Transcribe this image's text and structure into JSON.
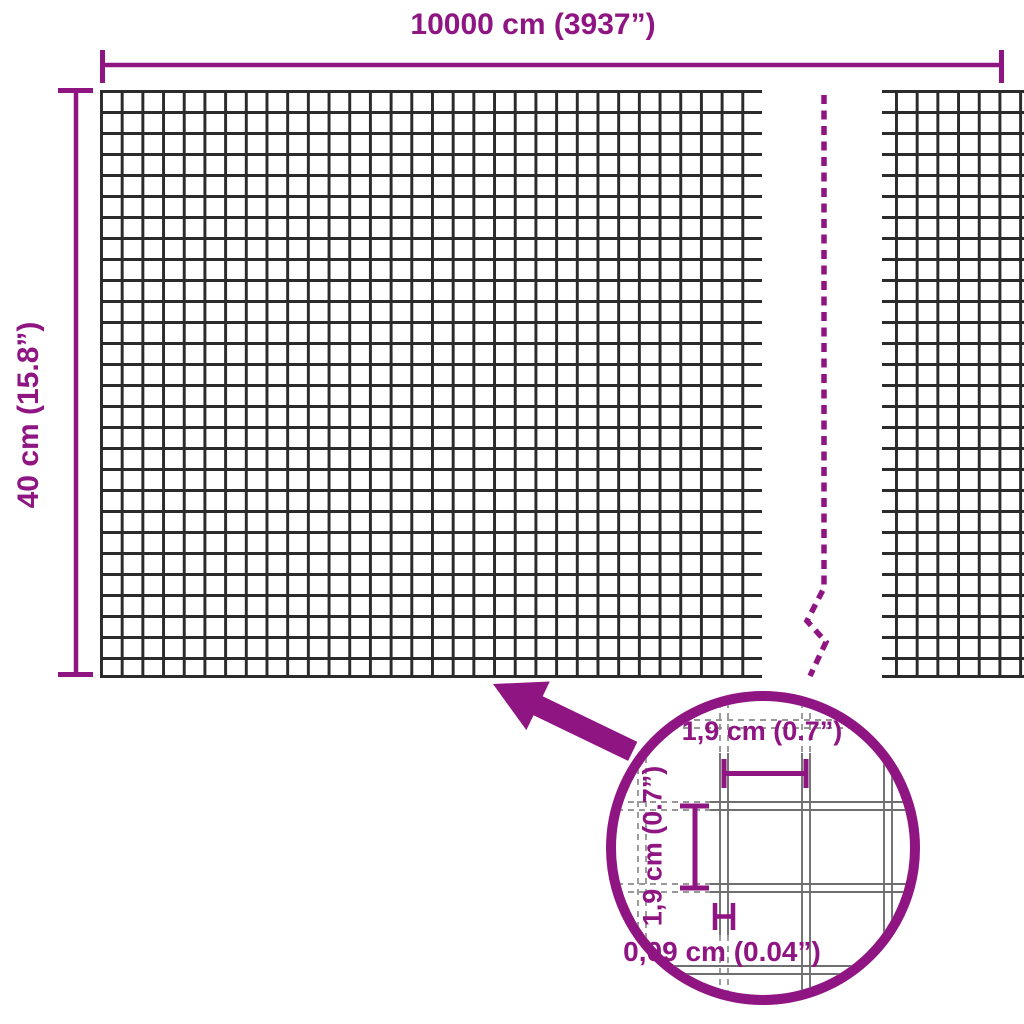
{
  "diagram": {
    "type": "product-dimensions-wire-mesh",
    "width_dimension": {
      "label": "10000 cm (3937”)"
    },
    "height_dimension": {
      "label": "40 cm (15.8”)"
    },
    "detail_view": {
      "opening_width": {
        "label": "1,9 cm (0.7”)"
      },
      "opening_height": {
        "label": "1,9 cm (0.7”)"
      },
      "wire_thickness": {
        "label": "0,09 cm (0.04”)"
      }
    }
  },
  "colors": {
    "accent": "#8F1583",
    "mesh_wire": "#2B2B2B",
    "detail_wire": "#6E6E6E",
    "detail_wire_dashed": "#8A8A8A",
    "background": "#FFFFFF"
  },
  "icons": {
    "pointer_arrow": "arrow-pointing-up-left",
    "break_line": "dashed-zigzag-break-line",
    "zoom_circle": "magnifier-detail-circle",
    "dimension_ticks": "capped-dimension-lines"
  }
}
